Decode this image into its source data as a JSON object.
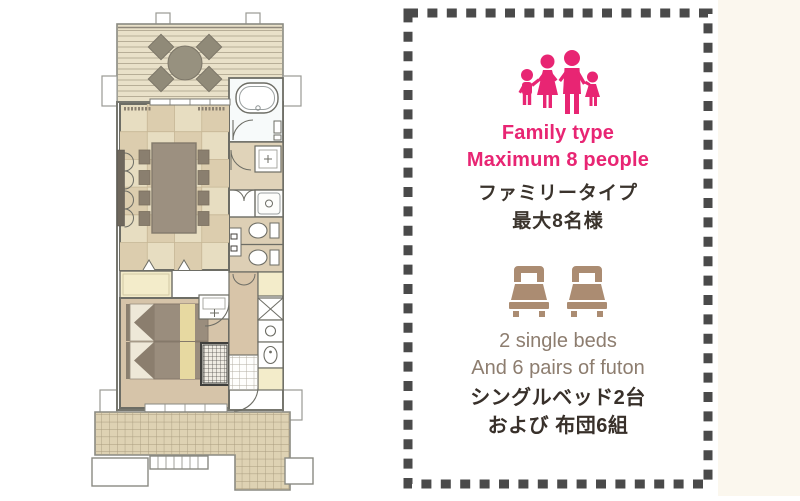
{
  "page": {
    "right_strip_color": "#fbf7ee"
  },
  "floor_plan": {
    "name": "family-room-floor-plan",
    "rooms": [
      "wood deck",
      "tatami dining room",
      "bathroom",
      "washroom",
      "shower",
      "toilet",
      "toilet",
      "bedroom",
      "kitchen",
      "entrance",
      "tile terrace"
    ],
    "colors": {
      "deck": "#e9e1c9",
      "tatami_light": "#e7ddc1",
      "tatami_dark": "#dccdae",
      "bedroom_floor": "#d6c4a9",
      "corridor": "#d8c5a9",
      "tile_terrace": "#ded2b3",
      "furniture": "#9c9080",
      "closet_cream": "#f3ecca",
      "bed_blanket": "#9a8d7d",
      "bed_stripe": "#e7d9a1"
    }
  },
  "panel": {
    "border_color": "#4a4a4a",
    "capacity": {
      "icon": "family-icon",
      "icon_color": "#e82573",
      "en": [
        "Family type",
        "Maximum 8 people"
      ],
      "jp": [
        "ファミリータイプ",
        "最大8名様"
      ]
    },
    "bedding": {
      "icon": "single-bed-icon",
      "icon_color": "#ab8c72",
      "bed_count": 2,
      "en": [
        "2 single beds",
        "And 6 pairs of futon"
      ],
      "jp": [
        "シングルベッド2台",
        "および 布団6組"
      ]
    }
  }
}
